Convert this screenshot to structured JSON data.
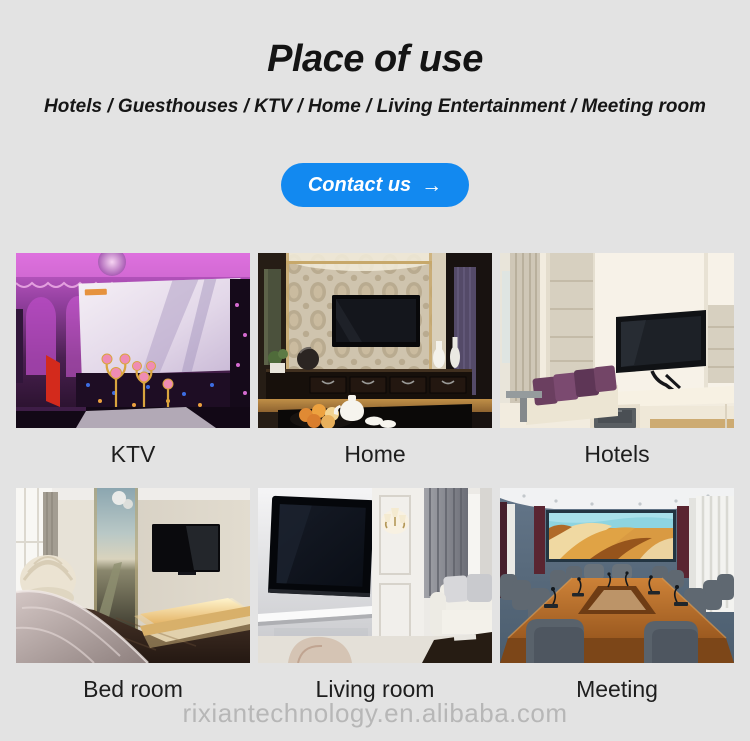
{
  "header": {
    "title": "Place of use",
    "subtitle": "Hotels / Guesthouses / KTV / Home / Living Entertainment / Meeting room",
    "contact_button": {
      "label": "Contact us",
      "arrow": "→"
    }
  },
  "gallery": {
    "items": [
      {
        "label": "KTV",
        "photo": "ktv-karaoke-room"
      },
      {
        "label": "Home",
        "photo": "home-tv-wall"
      },
      {
        "label": "Hotels",
        "photo": "hotel-guest-room"
      },
      {
        "label": "Bed room",
        "photo": "bedroom-tv-wall"
      },
      {
        "label": "Living room",
        "photo": "living-room-tv-wall"
      },
      {
        "label": "Meeting",
        "photo": "meeting-room-led-screen"
      }
    ]
  },
  "footer": {
    "watermark": "rixiantechnology.en.alibaba.com"
  },
  "colors": {
    "background": "#e3e3e3",
    "button_blue": "#1289f0",
    "button_text": "#ffffff",
    "heading_text": "#141414",
    "caption_text": "#1e1e1e",
    "watermark_gray": "#b7b7b7"
  }
}
